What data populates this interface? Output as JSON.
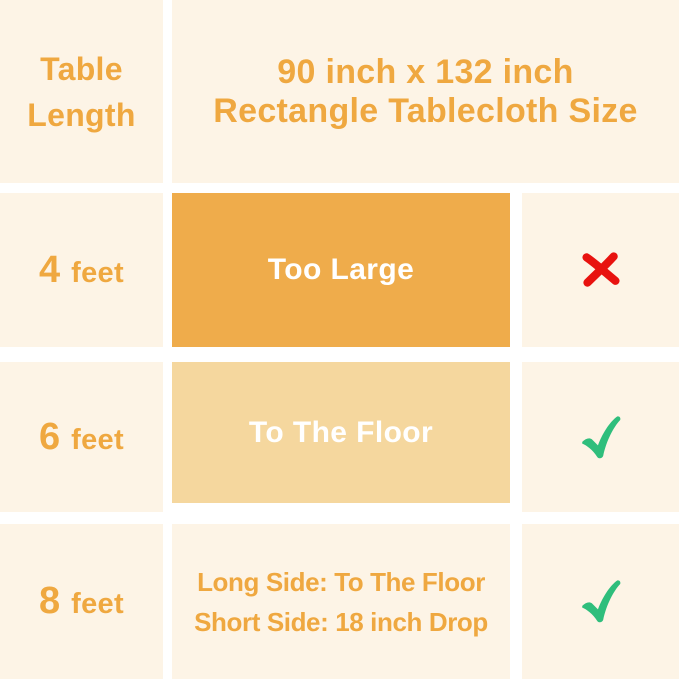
{
  "title": {
    "column_header": "Table Length",
    "line1": "90 inch x 132 inch",
    "line2": "Rectangle Tablecloth Size"
  },
  "rows": [
    {
      "length_number": "4",
      "length_unit": "feet",
      "fit_text": "Too Large",
      "verdict": "cross"
    },
    {
      "length_number": "6",
      "length_unit": "feet",
      "fit_text": "To The Floor",
      "verdict": "check"
    },
    {
      "length_number": "8",
      "length_unit": "feet",
      "fit_line1": "Long Side: To The Floor",
      "fit_line2": "Short Side: 18 inch Drop",
      "verdict": "check"
    }
  ],
  "icons": {
    "cross": "cross-icon",
    "check": "check-icon"
  },
  "colors": {
    "background": "#FDF4E6",
    "divider": "#FFFFFF",
    "accent_dark": "#EFAC4B",
    "accent_light": "#F5D79E",
    "text_orange": "#EFA840",
    "text_white": "#FFFFFF",
    "cross_red": "#E8120F",
    "check_green": "#2FBE7C"
  },
  "chart_data": {
    "type": "table",
    "title": "90 inch x 132 inch Rectangle Tablecloth Size",
    "columns": [
      "Table Length",
      "90 inch x 132 inch Rectangle Tablecloth Size",
      "Suitable"
    ],
    "rows": [
      [
        "4 feet",
        "Too Large",
        "no"
      ],
      [
        "6 feet",
        "To The Floor",
        "yes"
      ],
      [
        "8 feet",
        "Long Side: To The Floor; Short Side: 18 inch Drop",
        "yes"
      ]
    ],
    "legend_position": "none",
    "grid": false
  }
}
